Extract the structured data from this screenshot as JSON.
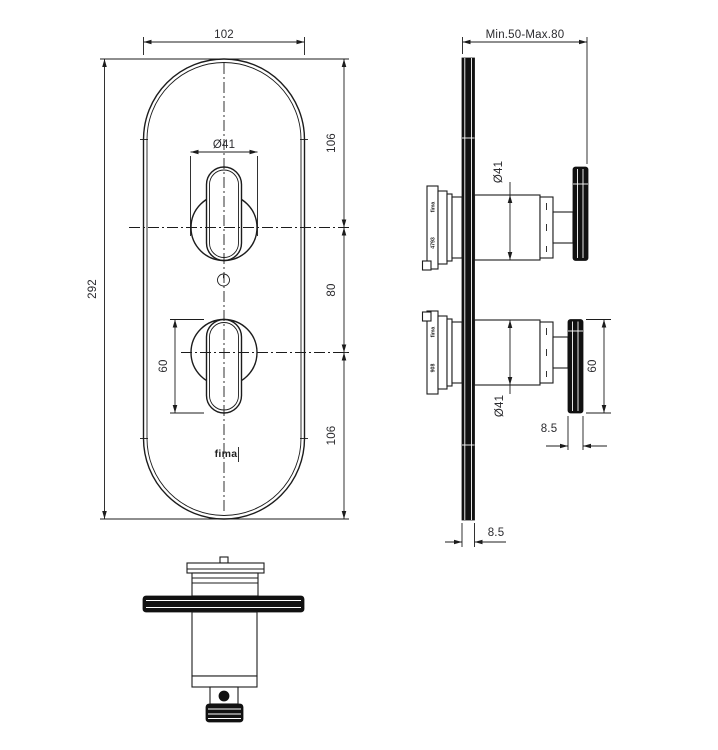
{
  "drawing": {
    "type": "technical-installation-drawing",
    "subject": "built-in thermostatic shower mixer with oval plate and two knobs",
    "ink_color": "#1c1c1c",
    "background_color": "#ffffff",
    "units": "mm"
  },
  "front": {
    "width": "102",
    "height": "292",
    "knob_diameter": "Ø41",
    "top_offset": "106",
    "center_gap": "80",
    "bottom_offset": "106",
    "handle_length": "60",
    "brand": "fima"
  },
  "side": {
    "depth_range": "Min.50-Max.80",
    "upper_knob_diameter": "Ø41",
    "lower_knob_diameter": "Ø41",
    "handle_length": "60",
    "handle_thickness": "8.5",
    "plate_thickness": "8.5",
    "upper_cartridge": {
      "brand": "fima",
      "code": "4793"
    },
    "lower_cartridge": {
      "brand": "fima",
      "code": "908"
    }
  }
}
